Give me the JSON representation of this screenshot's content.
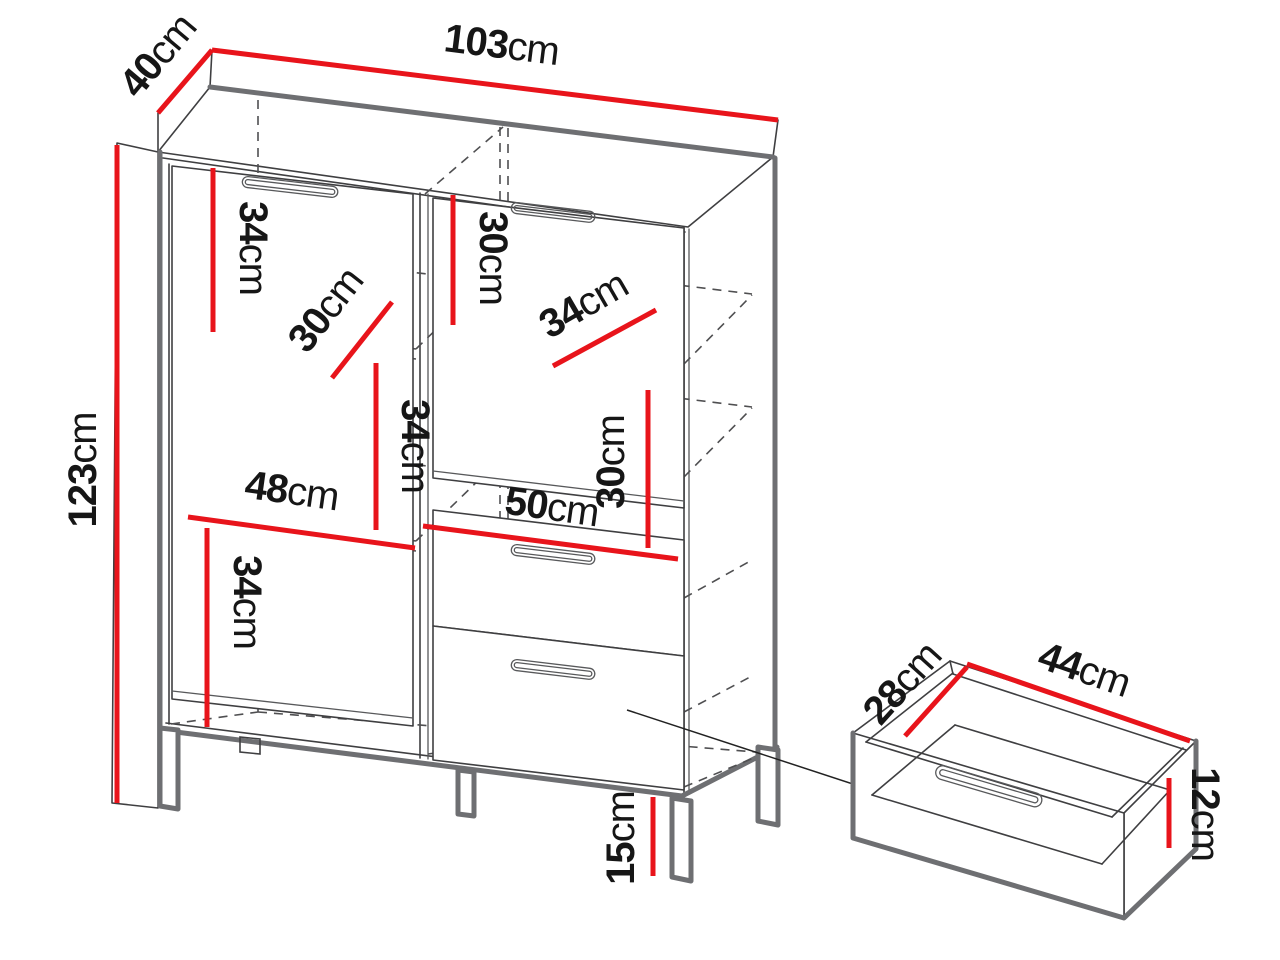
{
  "diagram_title": "cabinet-dimension-diagram",
  "colors": {
    "dimension_line": "#e8141b",
    "edge_thick": "#6e6f72",
    "edge_thin": "#3f3f41",
    "hidden_dash": "#4f4f51",
    "label_text": "#161616",
    "background": "#ffffff"
  },
  "cabinet": {
    "dimensions": {
      "width": {
        "num": "103",
        "unit": "cm"
      },
      "depth": {
        "num": "40",
        "unit": "cm"
      },
      "height": {
        "num": "123",
        "unit": "cm"
      },
      "left_top_section_height": {
        "num": "34",
        "unit": "cm"
      },
      "left_shelf_depth": {
        "num": "30",
        "unit": "cm"
      },
      "right_top_section_height": {
        "num": "30",
        "unit": "cm"
      },
      "right_shelf_depth": {
        "num": "34",
        "unit": "cm"
      },
      "left_middle_section_height": {
        "num": "34",
        "unit": "cm"
      },
      "right_middle_section_height": {
        "num": "30",
        "unit": "cm"
      },
      "left_compartment_width": {
        "num": "48",
        "unit": "cm"
      },
      "right_compartment_width": {
        "num": "50",
        "unit": "cm"
      },
      "left_bottom_section_height": {
        "num": "34",
        "unit": "cm"
      },
      "leg_height": {
        "num": "15",
        "unit": "cm"
      }
    }
  },
  "drawer_detail": {
    "dimensions": {
      "depth": {
        "num": "28",
        "unit": "cm"
      },
      "width": {
        "num": "44",
        "unit": "cm"
      },
      "height": {
        "num": "12",
        "unit": "cm"
      }
    }
  }
}
